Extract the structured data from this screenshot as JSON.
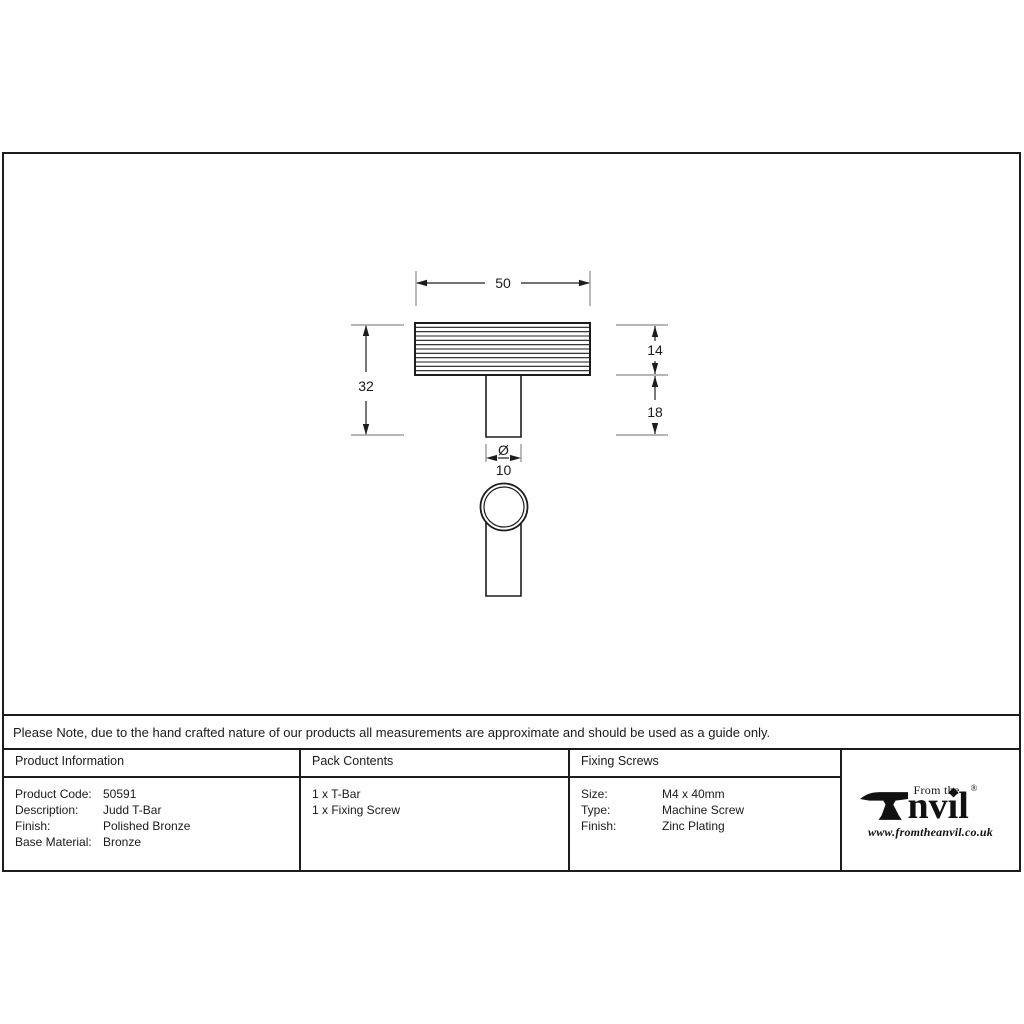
{
  "note": "Please Note, due to the hand crafted nature of our products all measurements are approximate and should be used as a guide only.",
  "drawing": {
    "dimensions": {
      "bar_width": "50",
      "overall_height": "32",
      "bar_height": "14",
      "stem_height": "18",
      "diameter_symbol": "Ø",
      "stem_diameter": "10"
    }
  },
  "table": {
    "product_information": {
      "header": "Product Information",
      "rows": [
        {
          "label": "Product Code:",
          "value": "50591"
        },
        {
          "label": "Description:",
          "value": "Judd T-Bar"
        },
        {
          "label": "Finish:",
          "value": "Polished Bronze"
        },
        {
          "label": "Base Material:",
          "value": "Bronze"
        }
      ]
    },
    "pack_contents": {
      "header": "Pack Contents",
      "items": [
        "1 x T-Bar",
        "1 x Fixing Screw"
      ]
    },
    "fixing_screws": {
      "header": "Fixing Screws",
      "rows": [
        {
          "label": "Size:",
          "value": "M4 x 40mm"
        },
        {
          "label": "Type:",
          "value": "Machine Screw"
        },
        {
          "label": "Finish:",
          "value": "Zinc Plating"
        }
      ]
    }
  },
  "logo": {
    "top_text": "From the",
    "brand_rest": "nvil",
    "registered": "®",
    "website": "www.fromtheanvil.co.uk"
  },
  "colors": {
    "line": "#1d1d1d",
    "extension_line": "#8a8a8a",
    "text": "#1a1a1a"
  }
}
